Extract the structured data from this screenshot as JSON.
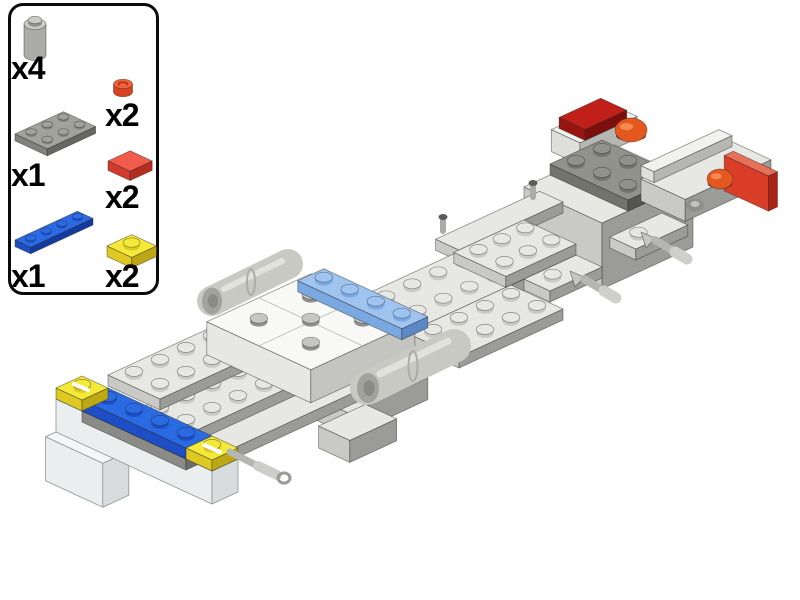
{
  "canvas": {
    "width": 800,
    "height": 600,
    "background": "#ffffff"
  },
  "parts_panel": {
    "items": [
      {
        "id": "brick-1x1-round-gray",
        "label": "x4",
        "color": "#c9c9c5"
      },
      {
        "id": "plate-1x1-round-red",
        "label": "x2",
        "color": "#f0633a"
      },
      {
        "id": "plate-2x3-gray",
        "label": "x1",
        "color": "#a2a29c"
      },
      {
        "id": "tile-1x1-red",
        "label": "x2",
        "color": "#f15b4b"
      },
      {
        "id": "plate-1x4-blue",
        "label": "x1",
        "color": "#2a6ae2"
      },
      {
        "id": "plate-1x1-trans-yellow",
        "label": "x2",
        "color": "#f4e838"
      }
    ]
  },
  "palette": {
    "lg": {
      "t": "#e7e7e3",
      "l": "#c9c9c5",
      "r": "#9b9b97"
    },
    "wh": {
      "t": "#f8f8f6",
      "l": "#e7e7e4",
      "r": "#c4c4c1",
      "g": "#c2c2be"
    },
    "wh2": {
      "t": "#f1f1ee",
      "l": "#dededb",
      "r": "#b6b6b3"
    },
    "mg": {
      "t": "#b2b2ae",
      "l": "#8a8a86",
      "r": "#6d6d69"
    },
    "dg": {
      "t": "#92928c",
      "l": "#73736d",
      "r": "#565650"
    },
    "bl": {
      "t": "#2a6ae2",
      "l": "#1d4ec6",
      "r": "#123a9f"
    },
    "mb": {
      "t": "#9fc4f0",
      "l": "#7aa8e0",
      "r": "#5c88c6"
    },
    "ty": {
      "t": "#f4e838",
      "l": "#ddc922",
      "r": "#bda714"
    },
    "cl": {
      "t": "#f5f7f7",
      "l": "#ebeeee",
      "r": "#d9dcdc",
      "k": "#8f9496"
    },
    "dr": {
      "t": "#c01f1a",
      "l": "#98140f",
      "r": "#7c0f0b"
    },
    "trp": {
      "t": "#e8705a",
      "l": "#da3d28",
      "r": "#ad2416"
    },
    "sg": {
      "t": "#c6c6c2",
      "l": "#8f8f8b",
      "r": "#8f8f8b"
    },
    "pg": {
      "t": "#a2a29c",
      "l": "#82827c",
      "r": "#676761"
    },
    "rt": {
      "t": "#f15b4b",
      "l": "#d23a2c",
      "r": "#b52c20"
    },
    "cg": {
      "side": "#ababa7",
      "top": "#c9c9c5",
      "shade": "#8f8f8b"
    },
    "cr": {
      "side": "#d8431f",
      "top": "#f0633a",
      "shade": "#b03010"
    }
  },
  "thumbs": [
    {
      "proj": {
        "x0": 0,
        "y0": 0,
        "s": 1
      },
      "elements": [
        {
          "kind": "cyl",
          "x": 22,
          "y": 47,
          "r": 11,
          "h": 31,
          "c": "cg",
          "stud": true,
          "name": "thumb-round-brick"
        }
      ]
    },
    {
      "proj": {
        "x0": 0,
        "y0": 0,
        "s": 1
      },
      "elements": [
        {
          "kind": "cyl",
          "x": 18,
          "y": 26,
          "r": 9.5,
          "h": 8,
          "c": "cr",
          "inner": true,
          "name": "thumb-round-plate-red"
        }
      ]
    },
    {
      "proj": {
        "x0": 4,
        "y0": 34,
        "s": 0.62
      },
      "elements": [
        {
          "kind": "box",
          "c": "pg",
          "i": 0,
          "j": 0,
          "li": 3,
          "lj": 2,
          "k": 0,
          "h": 1,
          "studs": "all",
          "name": "thumb-plate-2x3"
        }
      ]
    },
    {
      "proj": {
        "x0": 3,
        "y0": 17,
        "s": 0.85
      },
      "elements": [
        {
          "kind": "box",
          "c": "rt",
          "i": 0,
          "j": 0,
          "li": 1,
          "lj": 1,
          "k": 0,
          "h": 1,
          "name": "thumb-tile-red"
        }
      ]
    },
    {
      "proj": {
        "x0": 4,
        "y0": 36,
        "s": 0.6
      },
      "elements": [
        {
          "kind": "box",
          "c": "bl",
          "i": 0,
          "j": 0,
          "li": 4,
          "lj": 1,
          "k": 0,
          "h": 1,
          "studs": "all",
          "name": "thumb-plate-1x4-blue"
        }
      ]
    },
    {
      "proj": {
        "x0": 4,
        "y0": 20,
        "s": 0.95
      },
      "elements": [
        {
          "kind": "box",
          "c": "ty",
          "i": 0,
          "j": 0,
          "li": 1,
          "lj": 1,
          "k": 0,
          "h": 1,
          "studs": "all",
          "name": "thumb-plate-trans-yellow"
        }
      ]
    }
  ],
  "model": {
    "proj": {
      "x0": 56,
      "y0": 399,
      "s": 1
    },
    "elements": [
      {
        "kind": "box",
        "c": "wh2",
        "i": 18,
        "j": 1.05,
        "li": 2.2,
        "lj": 1.1,
        "k": 6,
        "h": 2,
        "name": "rear-left-brick"
      },
      {
        "kind": "box",
        "c": "dr",
        "i": 18.2,
        "j": 1.15,
        "li": 1.6,
        "lj": 1,
        "k": 7,
        "h": 1,
        "name": "rear-left-red-tile"
      },
      {
        "kind": "box",
        "c": "lg",
        "i": 16,
        "j": 2,
        "li": 3.5,
        "lj": 3,
        "k": 4,
        "h": 6,
        "name": "rear-engine-block"
      },
      {
        "kind": "box",
        "c": "lg",
        "i": 13.5,
        "j": 1.1,
        "li": 4,
        "lj": 0.9,
        "k": 1,
        "h": 1,
        "name": "rear-left-edge-plate"
      },
      {
        "kind": "box",
        "c": "dg",
        "i": 17,
        "j": 2,
        "li": 2,
        "lj": 3,
        "k": 5,
        "h": 1,
        "studs": "all",
        "name": "dark-gray-plate-2x3"
      },
      {
        "kind": "dome",
        "x": 631,
        "y": 130,
        "rx": 16,
        "ry": 12,
        "name": "orange-dome-left"
      },
      {
        "kind": "box",
        "c": "lg",
        "i": 19.5,
        "j": 3,
        "li": 3.3,
        "lj": 1.7,
        "k": 2,
        "h": 2,
        "name": "rear-right-extension"
      },
      {
        "kind": "box",
        "c": "wh2",
        "i": 19.6,
        "j": 2.9,
        "li": 3,
        "lj": 0.5,
        "k": 3,
        "h": 1,
        "name": "rear-right-top-strip"
      },
      {
        "kind": "box",
        "c": "trp",
        "i": 22.4,
        "j": 3.3,
        "li": 0.35,
        "lj": 1.7,
        "k": 1.3,
        "h": 3.2,
        "name": "rear-red-cap"
      },
      {
        "kind": "dome",
        "x": 720,
        "y": 179,
        "rx": 13,
        "ry": 10,
        "name": "orange-dome-right"
      },
      {
        "kind": "ell",
        "x": 695,
        "y": 205,
        "rx": 9,
        "ry": 6.5,
        "f": "#8e8e8a",
        "name": "engine-recess"
      },
      {
        "kind": "ell",
        "x": 695,
        "y": 204,
        "rx": 4.5,
        "ry": 3,
        "f": "#c2c2be",
        "name": "engine-recess-stud"
      },
      {
        "kind": "box",
        "c": "lg",
        "i": 9,
        "j": 1.6,
        "li": 7,
        "lj": 2.4,
        "k": 0,
        "h": 1,
        "studs": "all",
        "name": "main-spine-plate"
      },
      {
        "kind": "box",
        "c": "lg",
        "i": 9.5,
        "j": 4,
        "li": 4,
        "lj": 2,
        "k": 0,
        "h": 1,
        "studs": "all",
        "name": "spine-side-plate"
      },
      {
        "kind": "box",
        "c": "lg",
        "i": 14,
        "j": 4,
        "li": 2,
        "lj": 1,
        "k": 0,
        "h": 1,
        "studs": [
          [
            0.6,
            0.5
          ]
        ],
        "name": "handle-plate-1"
      },
      {
        "kind": "poly",
        "pts": [
          [
            570,
            271
          ],
          [
            584,
            277
          ],
          [
            575,
            287
          ]
        ],
        "f": "#c6c6c2",
        "name": "handle-bracket-1"
      },
      {
        "kind": "bar",
        "x1": 584,
        "y1": 279,
        "x2": 604,
        "y2": 291,
        "r": 4,
        "f": "#b5b5b1",
        "name": "handle-bar-1"
      },
      {
        "kind": "bar",
        "x1": 604,
        "y1": 291,
        "x2": 616,
        "y2": 298,
        "r": 5.5,
        "f": "#cfcfcb",
        "name": "handle-bar-1-tip"
      },
      {
        "kind": "box",
        "c": "lg",
        "i": 17.4,
        "j": 3.9,
        "li": 2,
        "lj": 1,
        "k": 0,
        "h": 1,
        "studs": [
          [
            0.6,
            0.5
          ]
        ],
        "name": "handle-plate-2"
      },
      {
        "kind": "poly",
        "pts": [
          [
            641,
            232
          ],
          [
            655,
            238
          ],
          [
            646,
            248
          ]
        ],
        "f": "#c6c6c2",
        "name": "handle-bracket-2"
      },
      {
        "kind": "bar",
        "x1": 655,
        "y1": 240,
        "x2": 675,
        "y2": 252,
        "r": 4,
        "f": "#b5b5b1",
        "name": "handle-bar-2"
      },
      {
        "kind": "bar",
        "x1": 675,
        "y1": 252,
        "x2": 687,
        "y2": 259,
        "r": 5.5,
        "f": "#cfcfcb",
        "name": "handle-bar-2-tip"
      },
      {
        "kind": "box",
        "c": "lg",
        "i": 13.3,
        "j": 2,
        "li": 2.7,
        "lj": 2,
        "k": 1,
        "h": 1,
        "studs": "all",
        "name": "raised-plate-2x4"
      },
      {
        "kind": "bar",
        "x1": 443,
        "y1": 231,
        "x2": 443,
        "y2": 220,
        "r": 3,
        "f": "#aaaaa6",
        "name": "clip-post-1"
      },
      {
        "kind": "ell",
        "x": 443,
        "y": 217,
        "rx": 4.5,
        "ry": 3,
        "f": "#5a5a58",
        "name": "clip-post-1-cap"
      },
      {
        "kind": "bar",
        "x1": 533,
        "y1": 197,
        "x2": 533,
        "y2": 186,
        "r": 3,
        "f": "#aaaaa6",
        "name": "clip-post-2"
      },
      {
        "kind": "ell",
        "x": 533,
        "y": 183,
        "rx": 4.5,
        "ry": 3,
        "f": "#5a5a58",
        "name": "clip-post-2-cap"
      },
      {
        "kind": "box",
        "c": "lg",
        "i": 5.5,
        "j": 4.2,
        "li": 3,
        "lj": 1.6,
        "k": -1,
        "h": 2,
        "name": "under-plate-right"
      },
      {
        "kind": "box",
        "c": "lg",
        "i": 5.3,
        "j": 4.8,
        "li": 1.8,
        "lj": 1.2,
        "k": -3,
        "h": 2,
        "name": "under-plate-lower"
      },
      {
        "kind": "box",
        "c": "lg",
        "i": 1,
        "j": 3,
        "li": 7,
        "lj": 2,
        "k": -1,
        "h": 1,
        "name": "front-lower-plate"
      },
      {
        "kind": "box",
        "c": "lg",
        "i": 1,
        "j": 2,
        "li": 6,
        "lj": 2,
        "k": 0,
        "h": 1,
        "studs": "all",
        "name": "front-spine-plate"
      },
      {
        "kind": "box",
        "c": "lg",
        "i": 2,
        "j": 0,
        "li": 4,
        "lj": 2,
        "k": 0,
        "h": 1,
        "studs": "all",
        "name": "left-wing-plate"
      },
      {
        "kind": "bar",
        "x1": 229,
        "y1": 357,
        "x2": 241,
        "y2": 343,
        "r": 2.5,
        "f": "#9a9a96",
        "name": "lever"
      },
      {
        "kind": "ell",
        "x": 243,
        "y": 341,
        "rx": 3.5,
        "ry": 2.5,
        "f": "#4a4a48",
        "name": "lever-tip"
      },
      {
        "kind": "box",
        "c": "wh",
        "i": 5.2,
        "j": 0.6,
        "li": 4,
        "lj": 4,
        "k": 2,
        "h": 3,
        "grid": true,
        "sc": "sg",
        "studs": [
          [
            1,
            1
          ],
          [
            1,
            3
          ],
          [
            2,
            2
          ],
          [
            3,
            1
          ],
          [
            3,
            3
          ]
        ],
        "name": "white-tile-section"
      },
      {
        "kind": "box",
        "c": "mb",
        "i": 8.2,
        "j": 1.1,
        "li": 1,
        "lj": 4,
        "k": 3,
        "h": 1,
        "studs": "all",
        "name": "light-blue-plate-1x4"
      },
      {
        "kind": "bar",
        "x1": 212,
        "y1": 301,
        "x2": 288,
        "y2": 264,
        "r": 15,
        "f": "#c9c9c4",
        "name": "left-barrel"
      },
      {
        "kind": "ell",
        "x": 212,
        "y": 301,
        "rx": 10,
        "ry": 13.5,
        "f": "#a3a39e",
        "name": "left-barrel-opening"
      },
      {
        "kind": "ell",
        "x": 213,
        "y": 301,
        "rx": 5,
        "ry": 7,
        "f": "#8a8a86",
        "name": "left-barrel-bore"
      },
      {
        "kind": "bar",
        "x1": 224,
        "y1": 289,
        "x2": 282,
        "y2": 261,
        "r": 3,
        "f": "#e2e2dd",
        "name": "left-barrel-highlight"
      },
      {
        "kind": "ell",
        "x": 251,
        "y": 282,
        "rx": 4,
        "ry": 13,
        "f": "none",
        "st": "#adada8",
        "sw": 2,
        "name": "left-barrel-seam"
      },
      {
        "kind": "bar",
        "x1": 367,
        "y1": 388,
        "x2": 454,
        "y2": 346,
        "r": 17,
        "f": "#c9c9c4",
        "name": "right-barrel"
      },
      {
        "kind": "ell",
        "x": 368,
        "y": 388,
        "rx": 11,
        "ry": 15,
        "f": "#a3a39e",
        "name": "right-barrel-opening"
      },
      {
        "kind": "ell",
        "x": 369,
        "y": 388,
        "rx": 5.5,
        "ry": 8,
        "f": "#8a8a86",
        "name": "right-barrel-bore"
      },
      {
        "kind": "bar",
        "x1": 380,
        "y1": 374,
        "x2": 448,
        "y2": 341,
        "r": 3.5,
        "f": "#e2e2dd",
        "name": "right-barrel-highlight"
      },
      {
        "kind": "ell",
        "x": 413,
        "y": 366,
        "rx": 4.5,
        "ry": 15,
        "f": "none",
        "st": "#adada8",
        "sw": 2,
        "name": "right-barrel-seam"
      },
      {
        "kind": "box",
        "c": "cl",
        "i": -0.4,
        "j": 0,
        "li": 1,
        "lj": 2.2,
        "k": -3,
        "h": 4,
        "name": "front-clear-brick-lower"
      },
      {
        "kind": "box",
        "c": "cl",
        "i": 0,
        "j": 0,
        "li": 1,
        "lj": 6,
        "k": 0,
        "h": 3,
        "name": "front-clear-brick"
      },
      {
        "kind": "box",
        "c": "mg",
        "i": 0,
        "j": 1,
        "li": 1,
        "lj": 4,
        "k": 0,
        "h": 1,
        "name": "front-gray-strip"
      },
      {
        "kind": "box",
        "c": "bl",
        "i": 0,
        "j": 1,
        "li": 1,
        "lj": 4,
        "k": 1,
        "h": 1,
        "studs": "all",
        "name": "blue-plate-1x4"
      },
      {
        "kind": "box",
        "c": "ty",
        "i": 0,
        "j": 0,
        "li": 1,
        "lj": 1,
        "k": 1,
        "h": 1,
        "studs": "all",
        "name": "trans-yellow-plate-left"
      },
      {
        "kind": "box",
        "c": "ty",
        "i": 0,
        "j": 5,
        "li": 1,
        "lj": 1,
        "k": 1,
        "h": 1,
        "studs": "all",
        "name": "trans-yellow-plate-right"
      },
      {
        "kind": "bar",
        "x1": 230,
        "y1": 452,
        "x2": 258,
        "y2": 466,
        "r": 3.5,
        "f": "#b5b5b1",
        "name": "front-antenna-bar"
      },
      {
        "kind": "bar",
        "x1": 258,
        "y1": 466,
        "x2": 277,
        "y2": 475,
        "r": 5,
        "f": "#cdcdc9",
        "name": "front-antenna-grip"
      },
      {
        "kind": "ell",
        "x": 284,
        "y": 478,
        "rx": 6,
        "ry": 5,
        "f": "none",
        "st": "#9a9a96",
        "sw": 3,
        "name": "front-antenna-ring"
      },
      {
        "kind": "bar",
        "x1": 74,
        "y1": 384,
        "x2": 88,
        "y2": 390,
        "r": 2,
        "f": "#ffffff",
        "name": "yellow-highlight-left"
      },
      {
        "kind": "bar",
        "x1": 204,
        "y1": 445,
        "x2": 220,
        "y2": 452,
        "r": 2,
        "f": "#ffffff",
        "name": "yellow-highlight-right"
      }
    ]
  }
}
